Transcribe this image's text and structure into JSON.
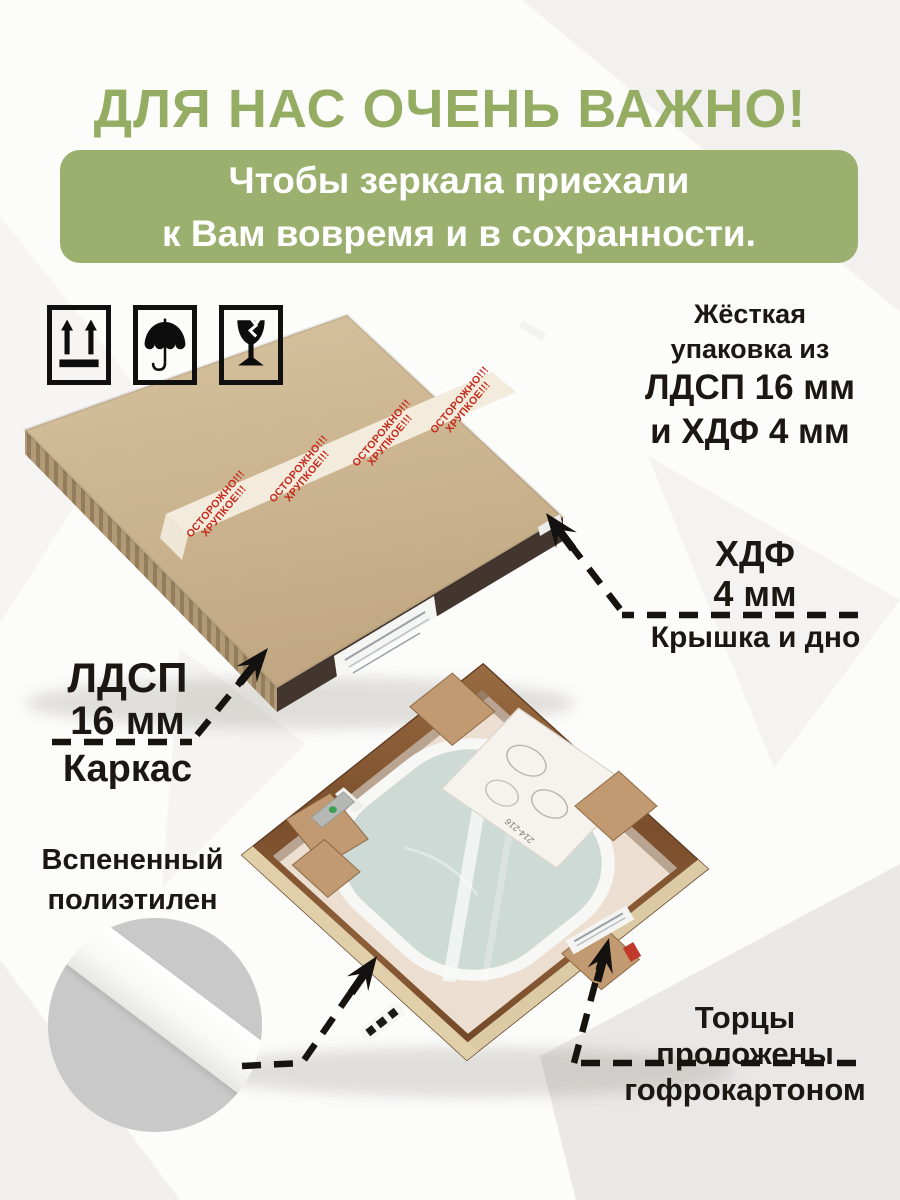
{
  "header": {
    "title": "ДЛЯ НАС ОЧЕНЬ ВАЖНО!"
  },
  "banner": {
    "line1": "Чтобы зеркала приехали",
    "line2": "к Вам вовремя и в сохранности."
  },
  "packaging_icons": {
    "icon1": "this-way-up",
    "icon2": "keep-dry-umbrella",
    "icon3": "fragile-glass"
  },
  "rigid_pack_note": {
    "line1": "Жёсткая",
    "line2": "упаковка из",
    "line3": "ЛДСП 16 мм",
    "line4": "и ХДФ 4 мм"
  },
  "hdf_label": {
    "material": "ХДФ",
    "thickness": "4 мм",
    "caption": "Крышка и дно"
  },
  "ldsp_label": {
    "material": "ЛДСП",
    "thickness": "16 мм",
    "caption": "Каркас"
  },
  "foam_label": {
    "line1": "Вспененный",
    "line2": "полиэтилен"
  },
  "edges_label": {
    "line1": "Торцы",
    "line2": "проложены",
    "line3": "гофрокартоном"
  },
  "warning_tape": {
    "line1": "ОСТОРОЖНО!!!",
    "line2": "ХРУПКОЕ!!!"
  },
  "instruction_sheet": {
    "code": "214-216"
  },
  "colors": {
    "heading_green": "#95ad63",
    "banner_green": "#9bb06e",
    "warning_red": "#c6291c",
    "kraft_board": "#ccb48f",
    "wood_frame": "#81532f",
    "mirror_film": "#cedad6",
    "foam_white": "#f7f7f5",
    "cardboard": "#c19a71",
    "circle_gray": "#c9c9c9",
    "text_black": "#1c1712"
  }
}
